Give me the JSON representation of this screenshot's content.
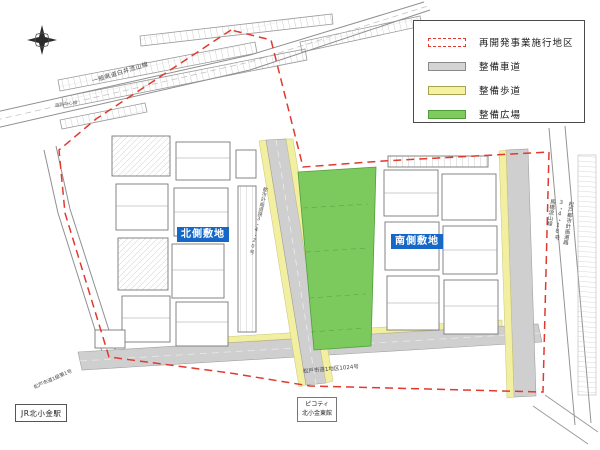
{
  "legend": {
    "items": [
      {
        "label": "再開発事業施行地区",
        "type": "district-boundary",
        "color": "#e0392e"
      },
      {
        "label": "整備車道",
        "type": "roadway",
        "color": "#d4d4d4"
      },
      {
        "label": "整備歩道",
        "type": "sidewalk",
        "color": "#f4f1a0"
      },
      {
        "label": "整備広場",
        "type": "plaza",
        "color": "#7fcb5e"
      }
    ]
  },
  "sites": {
    "north": "北側敷地",
    "south": "南側敷地"
  },
  "places": {
    "station": "JR北小金駅",
    "picoty_line1": "ピコティ",
    "picoty_line2": "北小金東館"
  },
  "roads": {
    "prefectural": "一般県道白井流山線",
    "centerline": "道路中心線",
    "city_south": "松戸市道1地区1024号",
    "city_southwest": "松戸市道1級第1号",
    "east_col1": "松戸都市計画道路",
    "east_col2": "3・4・18号",
    "east_col3": "馬橋流山線",
    "central": "都市計画道路3・4・20号"
  },
  "colors": {
    "district_boundary": "#e0392e",
    "roadway": "#cfcfcf",
    "sidewalk": "#f2efa0",
    "plaza": "#7cc95e",
    "site_tag_blue": "#1668c8"
  }
}
